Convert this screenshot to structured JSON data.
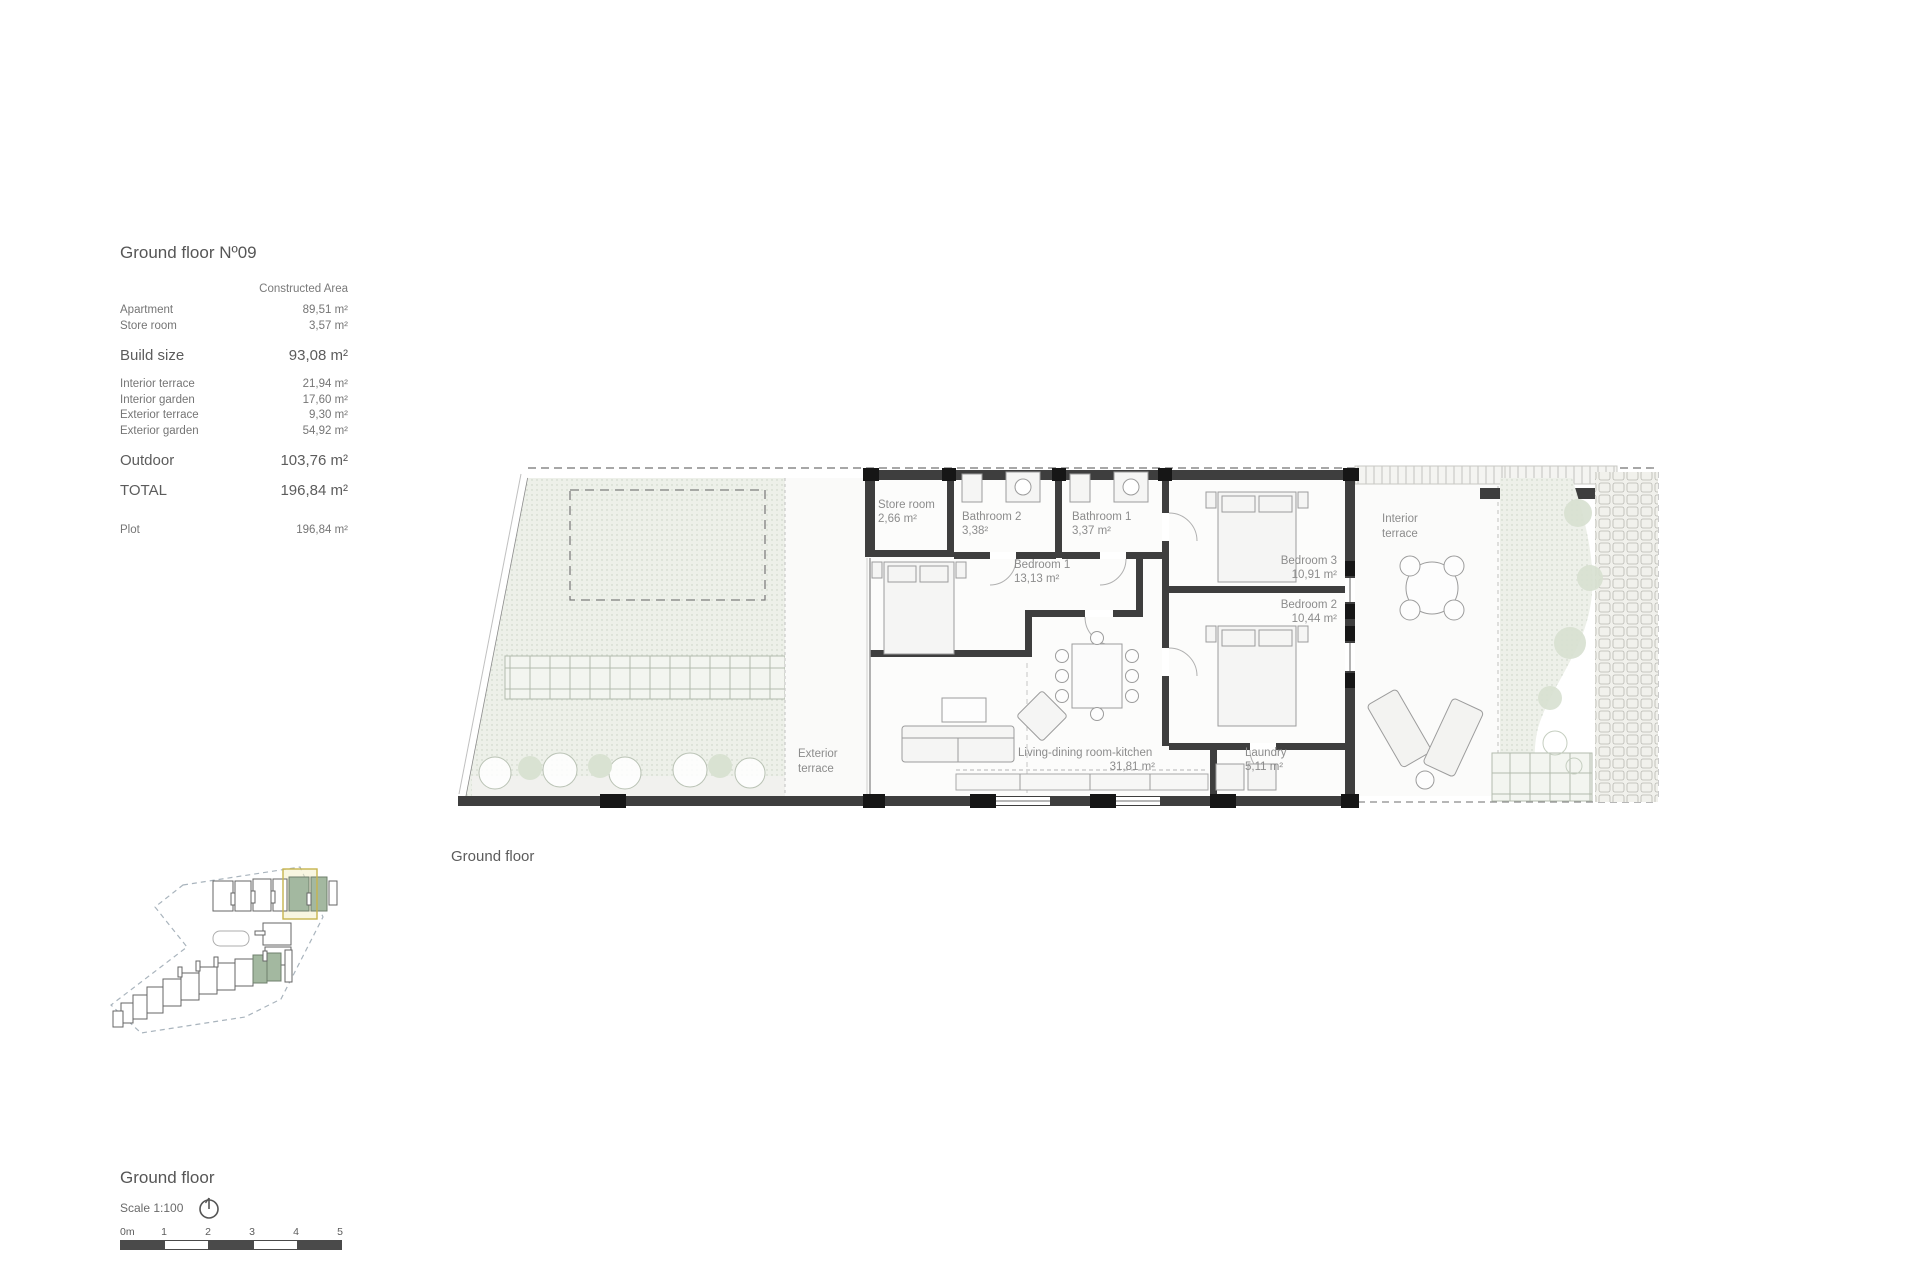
{
  "summary": {
    "title": "Ground floor Nº09",
    "column_header": "Constructed Area",
    "rows": [
      {
        "label": "Apartment",
        "value": "89,51 m²"
      },
      {
        "label": "Store room",
        "value": "3,57 m²"
      },
      {
        "label": "Build size",
        "value": "93,08 m²"
      },
      {
        "label": "Interior terrace",
        "value": "21,94 m²"
      },
      {
        "label": "Interior garden",
        "value": "17,60 m²"
      },
      {
        "label": "Exterior terrace",
        "value": "9,30 m²"
      },
      {
        "label": "Exterior garden",
        "value": "54,92 m²"
      },
      {
        "label": "Outdoor",
        "value": "103,76 m²"
      },
      {
        "label": "TOTAL",
        "value": "196,84 m²"
      },
      {
        "label": "Plot",
        "value": "196,84 m²"
      }
    ]
  },
  "plan": {
    "caption": "Ground floor",
    "rooms": {
      "store_room": {
        "name": "Store room",
        "area": "2,66 m²"
      },
      "bathroom2": {
        "name": "Bathroom 2",
        "area": "3,38²"
      },
      "bathroom1": {
        "name": "Bathroom 1",
        "area": "3,37 m²"
      },
      "bedroom1": {
        "name": "Bedroom 1",
        "area": "13,13 m²"
      },
      "bedroom3": {
        "name": "Bedroom 3",
        "area": "10,91 m²"
      },
      "bedroom2": {
        "name": "Bedroom 2",
        "area": "10,44 m²"
      },
      "living": {
        "name": "Living-dining room-kitchen",
        "area": "31,81 m²"
      },
      "laundry": {
        "name": "Laundry",
        "area": "5,11 m²"
      },
      "exterior_terrace": {
        "line1": "Exterior",
        "line2": "terrace"
      },
      "interior_terrace": {
        "line1": "Interior",
        "line2": "terrace"
      }
    }
  },
  "footer": {
    "title": "Ground floor",
    "scale_label": "Scale 1:100",
    "scale_ticks": [
      "0m",
      "1",
      "2",
      "3",
      "4",
      "5"
    ]
  },
  "colors": {
    "wall": "#3e3e3e",
    "pier": "#161616",
    "garden_fill": "#edf0e9",
    "garden_dot": "#c7d0c2",
    "label_text": "#8c8c8c",
    "sitemap_unit_green": "#a3b8a0",
    "sitemap_highlight": "#c6b44e"
  }
}
